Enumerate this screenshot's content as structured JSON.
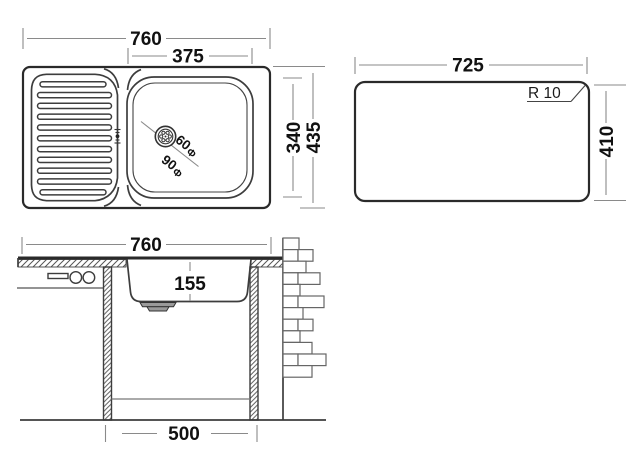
{
  "top_view": {
    "overall_width": "760",
    "bowl_width": "375",
    "bowl_inner_length": "340",
    "overall_length": "435",
    "drain": {
      "small": "60",
      "large": "90",
      "symbol": "Φ"
    }
  },
  "cutout_view": {
    "width": "725",
    "height": "410",
    "corner_radius": "R 10"
  },
  "section_view": {
    "width": "760",
    "bowl_depth": "155",
    "cabinet_width": "500"
  }
}
